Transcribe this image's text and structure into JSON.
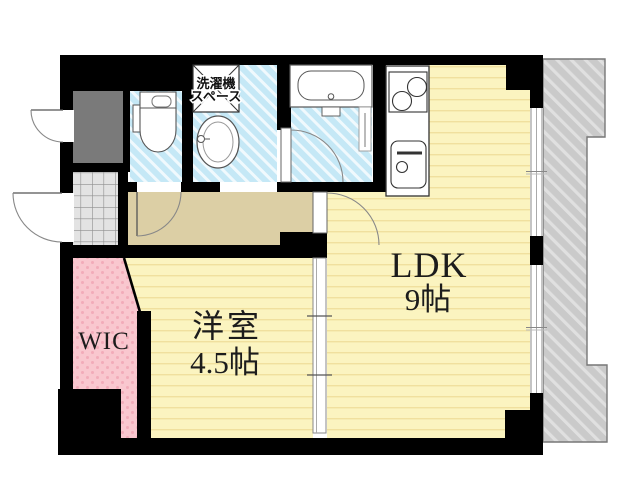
{
  "floorplan": {
    "type": "apartment-floor-plan",
    "rooms": {
      "ldk": {
        "name": "LDK",
        "size": "9帖"
      },
      "western": {
        "name": "洋室",
        "size": "4.5帖"
      },
      "wic": {
        "name": "WIC"
      },
      "laundry": {
        "line1": "洗濯機",
        "line2": "スペース"
      }
    },
    "colors": {
      "wall": "#000000",
      "room_yellow": "#fbf4c0",
      "room_yellow_stripe": "#f0e09e",
      "wet_area_blue": "#c5e8f6",
      "wic_pink": "#f9c7cf",
      "corridor_beige": "#dccfa5",
      "genkan_tile": "#e3e3e3",
      "balcony_gray": "#cacaca",
      "storage_gray": "#7a7a7a"
    }
  }
}
